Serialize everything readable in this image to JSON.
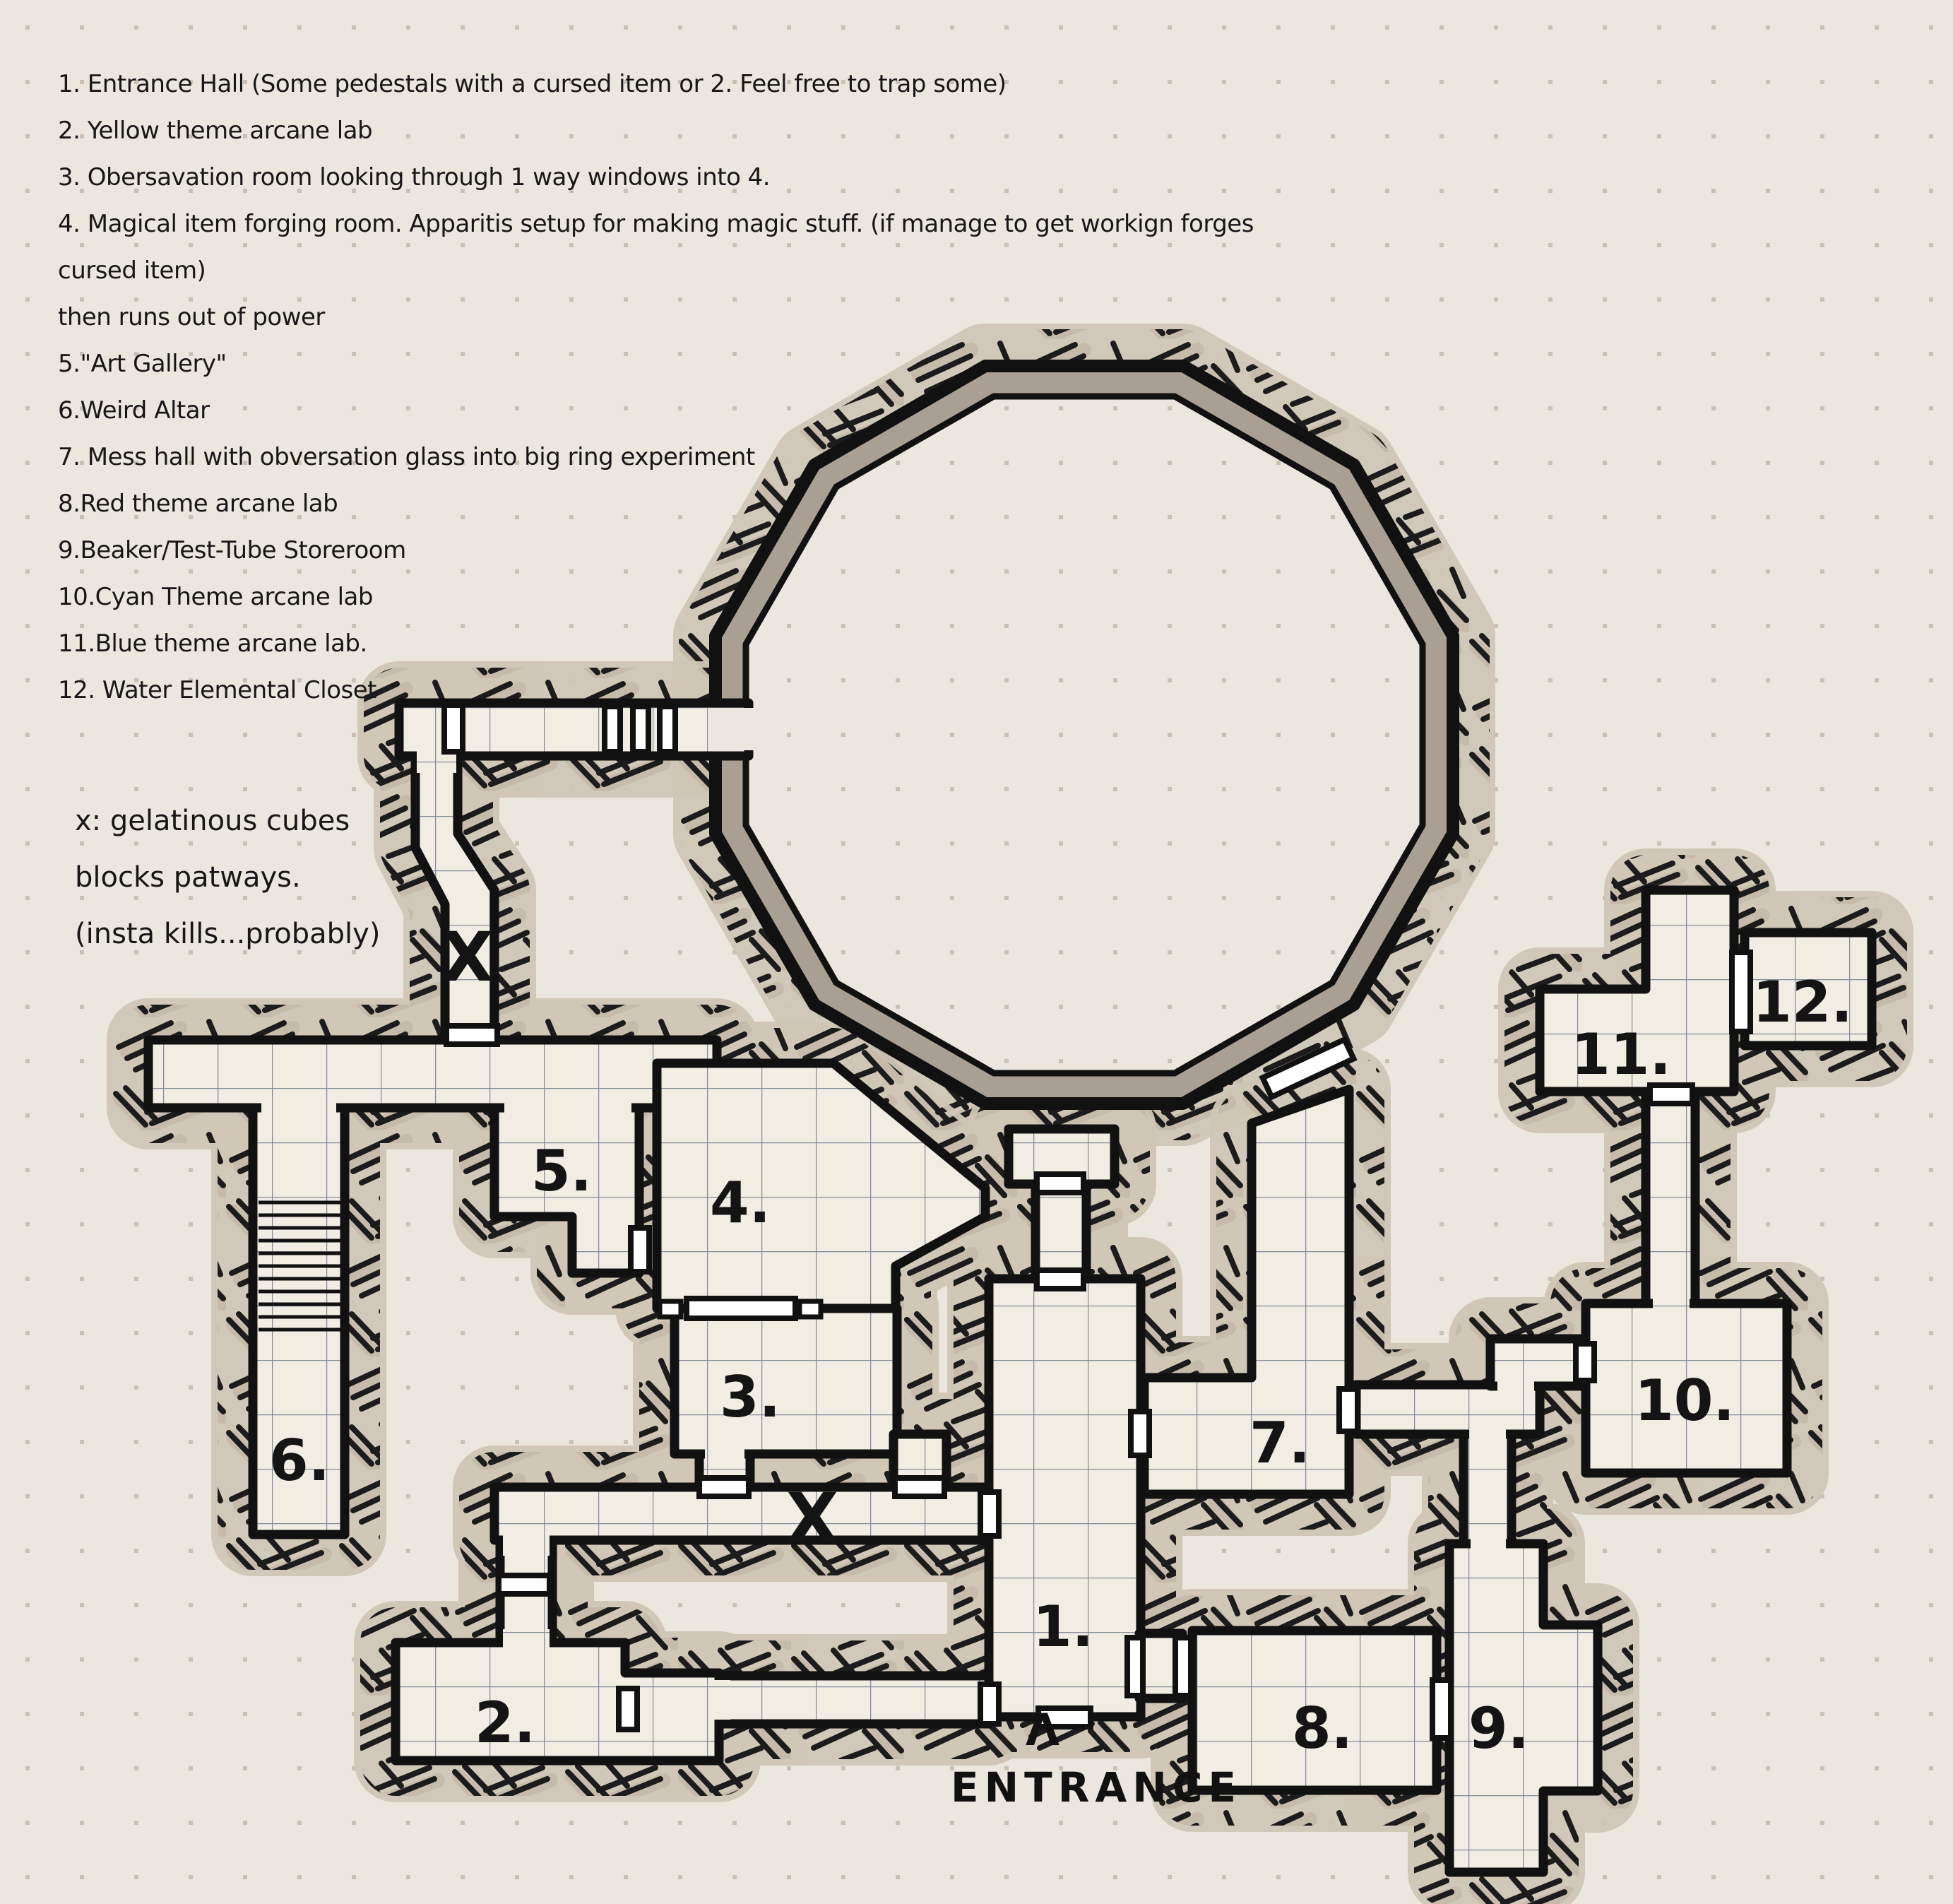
{
  "legend": {
    "lines": [
      "1. Entrance Hall (Some pedestals with a cursed item or 2. Feel free to trap some)",
      "2. Yellow theme arcane lab",
      "3. Obersavation room looking through 1 way windows into 4.",
      "4. Magical item forging room. Apparitis setup for making magic stuff. (if manage to get workign forges cursed item)",
      "then runs out of power",
      "5.\"Art Gallery\"",
      "6.Weird Altar",
      "7. Mess hall with obversation glass into big ring experiment",
      "8.Red theme arcane lab",
      "9.Beaker/Test-Tube Storeroom",
      "10.Cyan Theme arcane lab",
      "11.Blue theme arcane lab.",
      "12. Water Elemental Closet"
    ]
  },
  "note": {
    "lines": [
      "x: gelatinous cubes",
      "blocks patways.",
      "(insta kills...probably)"
    ]
  },
  "entrance": {
    "arrow": "Λ",
    "label": "ENTRANCE"
  },
  "marks": {
    "x1": "X",
    "x2": "X"
  },
  "rooms": {
    "labels": [
      "1.",
      "2.",
      "3.",
      "4.",
      "5.",
      "6.",
      "7.",
      "8.",
      "9.",
      "10.",
      "11.",
      "12."
    ]
  },
  "colors": {
    "paper": "#ECE7DE",
    "ink": "#131313",
    "room_fill": "#F1EDE3",
    "grid_line": "#838C9B",
    "hatch_tan": "#C6BBAA",
    "ring_band": "#A9A093",
    "paper_dots": "#C9C2B4",
    "door_fill": "#FFFFFF"
  }
}
